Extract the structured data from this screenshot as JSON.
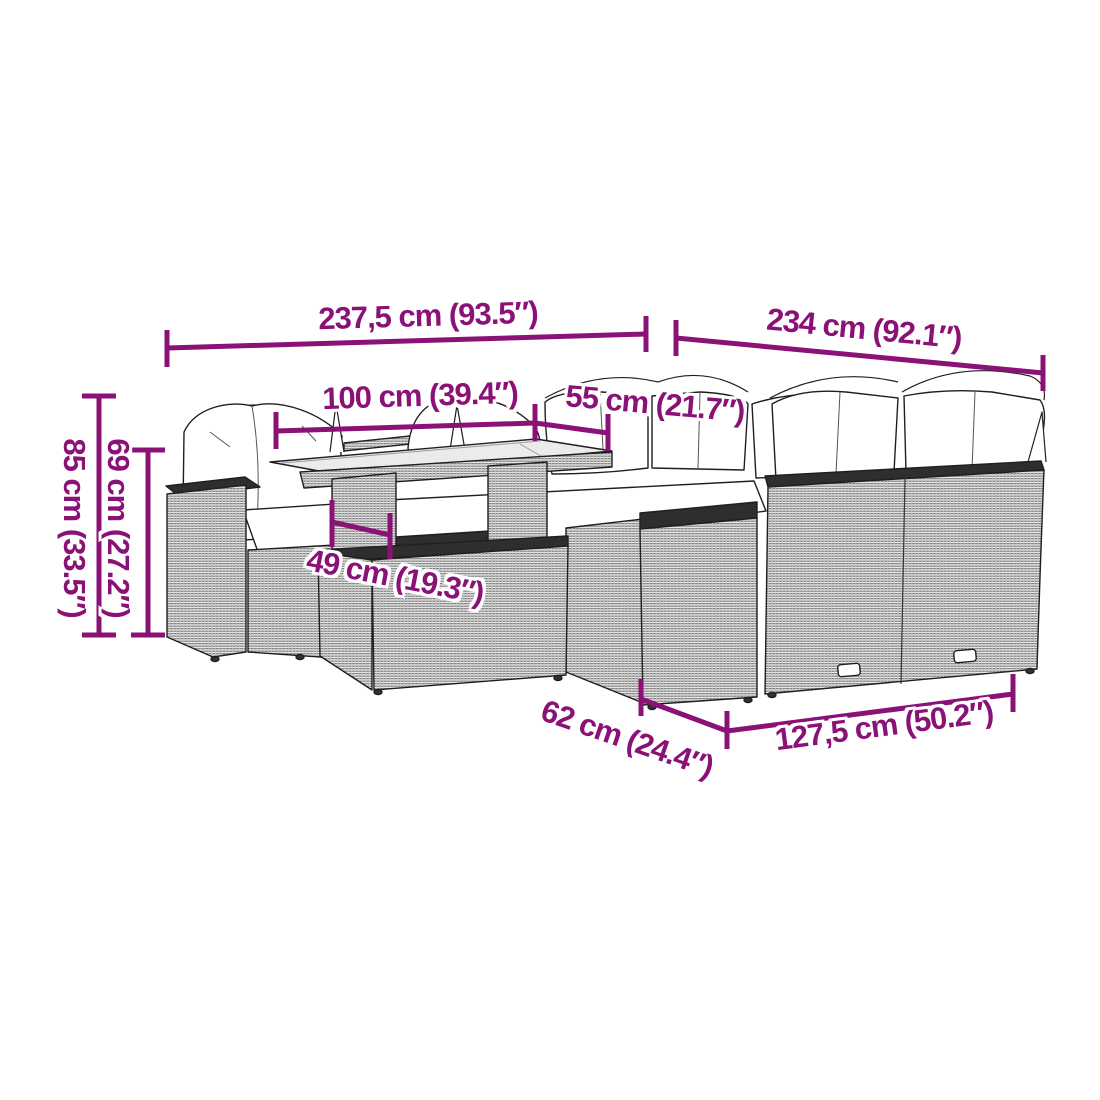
{
  "diagram": {
    "type": "furniture-dimension-diagram",
    "background": "#ffffff",
    "accent_color": "#8A1276",
    "outline_color": "#1f1f1f",
    "wicker_color": "#efefef",
    "cushion_color": "#ffffff",
    "glass_color": "#ebebeb"
  },
  "labels": {
    "top_left_width": "237,5 cm (93.5″)",
    "top_right_width": "234 cm (92.1″)",
    "table_length": "100 cm (39.4″)",
    "table_depth": "55 cm (21.7″)",
    "table_height": "49 cm (19.3″)",
    "seat_depth": "62 cm (24.4″)",
    "right_sofa_width": "127,5 cm (50.2″)",
    "total_height": "85 cm (33.5″)",
    "back_height": "69 cm (27.2″)"
  }
}
